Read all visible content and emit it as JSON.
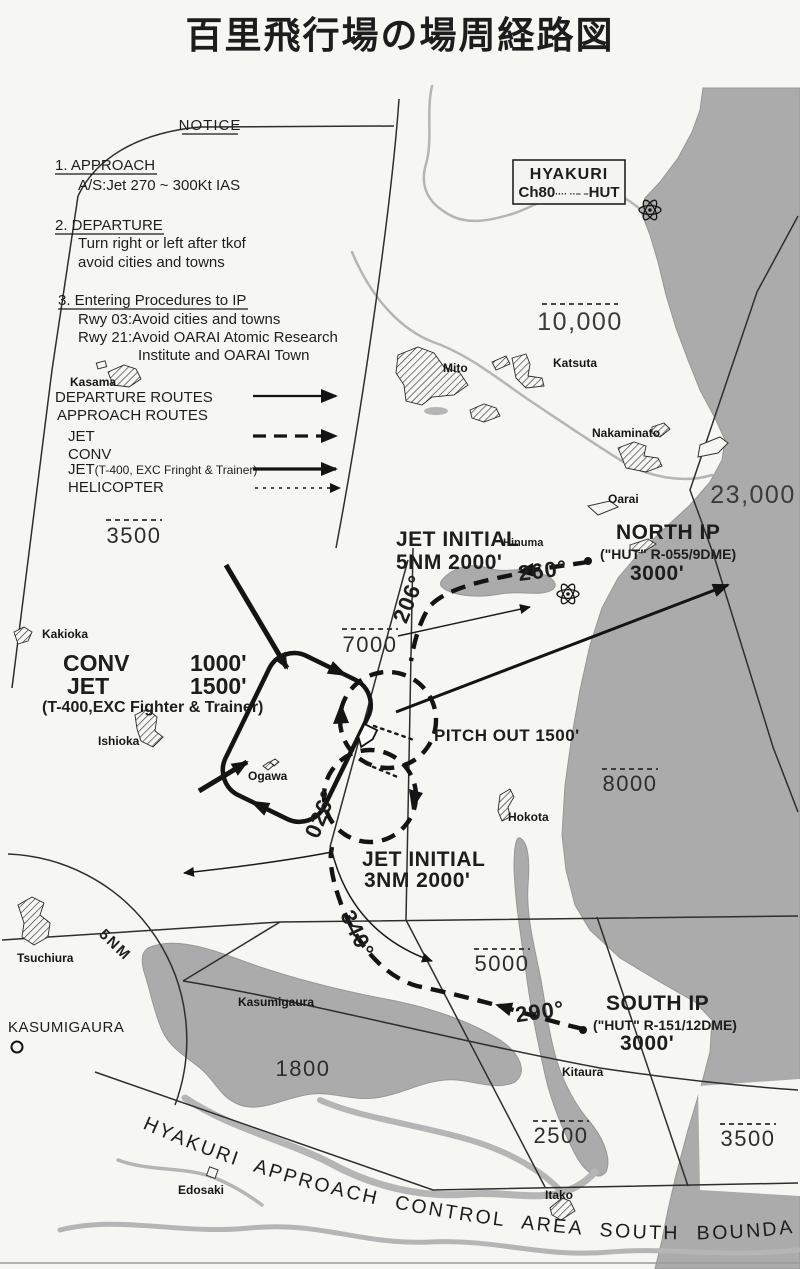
{
  "title": "百里飛行場の場周経路図",
  "notice": {
    "heading": "NOTICE",
    "approach_title": "1. APPROACH",
    "approach_body": "A/S:Jet 270 ~ 300Kt IAS",
    "departure_title": "2. DEPARTURE",
    "departure_body1": "Turn right or left after tkof",
    "departure_body2": "avoid cities and towns",
    "entering_title": "3. Entering Procedures to IP",
    "entering_body1": "Rwy 03:Avoid cities and towns",
    "entering_body2": "Rwy 21:Avoid OARAI Atomic Research",
    "entering_body3": "Institute and OARAI Town"
  },
  "legend": {
    "departure_routes": "DEPARTURE ROUTES",
    "approach_routes": "APPROACH ROUTES",
    "jet": "JET",
    "conv": "CONV",
    "jet_t400": "JET",
    "jet_t400_note": "(T-400, EXC Fringht & Trainer)",
    "helicopter": "HELICOPTER"
  },
  "navaid": {
    "name": "HYAKURI",
    "channel": "Ch80",
    "morse": "···· ··− −",
    "ident": "HUT"
  },
  "ips": {
    "north": {
      "name": "NORTH IP",
      "fix": "(\"HUT\" R-055/9DME)",
      "alt": "3000'"
    },
    "south": {
      "name": "SOUTH IP",
      "fix": "(\"HUT\" R-151/12DME)",
      "alt": "3000'"
    }
  },
  "jet_initial_north": {
    "line1": "JET INITIAL",
    "line2": "5NM 2000'"
  },
  "jet_initial_south": {
    "line1": "JET INITIAL",
    "line2": "3NM 2000'"
  },
  "pattern": {
    "pitch_out": "PITCH OUT 1500'",
    "conv_label": "CONV",
    "conv_alt": "1000'",
    "jet_label": "JET",
    "jet_alt": "1500'",
    "note": "(T-400,EXC Fighter & Trainer)"
  },
  "headings": {
    "h260": "260°",
    "h206": "206°",
    "h026": "026°",
    "h340": "340°",
    "h290": "290°"
  },
  "altitudes": {
    "nw": "3500",
    "north": "10,000",
    "sea_ne": "23,000",
    "center": "7000",
    "sea_e": "8000",
    "south_center": "5000",
    "lake": "1800",
    "south": "2500",
    "se": "3500"
  },
  "places": {
    "kasama": "Kasama",
    "mito": "Mito",
    "katsuta": "Katsuta",
    "nakaminato": "Nakaminato",
    "oarai": "Oarai",
    "hinuma": "Hinuma",
    "kakioka": "Kakioka",
    "ishioka": "Ishioka",
    "ogawa": "Ogawa",
    "hokota": "Hokota",
    "tsuchiura": "Tsuchiura",
    "kasumigaura_lake": "Kasumigaura",
    "kasumigaura_base": "KASUMIGAURA",
    "kitaura": "Kitaura",
    "edosaki": "Edosaki",
    "itako": "Itako"
  },
  "arc_label": "5NM",
  "boundary_text": "HYAKURI APPROACH CONTROL AREA SOUTH BOUNDARY",
  "colors": {
    "paper": "#f6f6f2",
    "water": "#ababab",
    "ink": "#1d1d1d"
  }
}
